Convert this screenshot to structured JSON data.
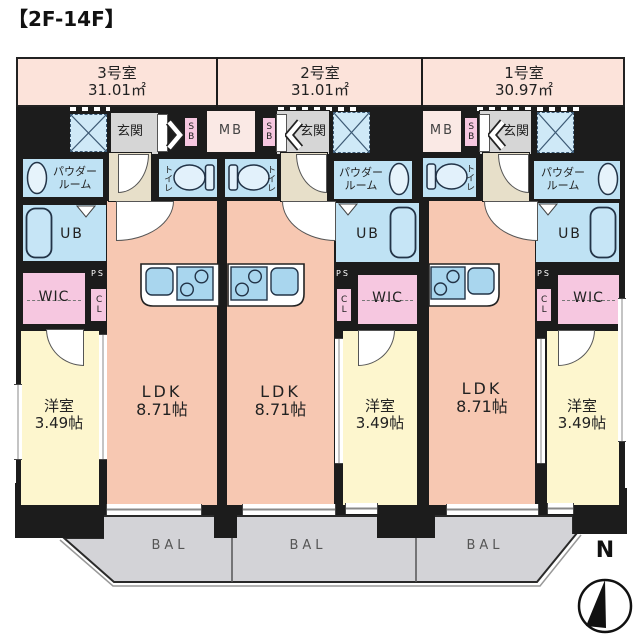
{
  "title": "【2F-14F】",
  "units": [
    {
      "name": "3号室",
      "area": "31.01㎡"
    },
    {
      "name": "2号室",
      "area": "31.01㎡"
    },
    {
      "name": "1号室",
      "area": "30.97㎡"
    }
  ],
  "rooms": {
    "genkan": "玄関",
    "mb": "MB",
    "sb": "SB",
    "toilet": "トイレ",
    "powder_line1": "パウダー",
    "powder_line2": "ルーム",
    "ub": "UB",
    "wic": "WIC",
    "ps": "PS",
    "cl": "CL",
    "ldk": "LDK",
    "ldk_size": "8.71帖",
    "bedroom": "洋室",
    "bedroom_size": "3.49帖"
  },
  "balcony": {
    "label": "BAL"
  },
  "compass": {
    "north": "N"
  },
  "colors": {
    "wall": "#1c1c1c",
    "band_pink": "#fce3da",
    "ldk_salmon": "#f7c8b2",
    "bedroom_yellow": "#fdf6ce",
    "wet_blue": "#bfe2f4",
    "closet_pink": "#f6c7e0",
    "entrance_gray": "#d6d6d6",
    "hall_beige": "#e7dfc9",
    "balcony_gray": "#d3d3d7"
  }
}
